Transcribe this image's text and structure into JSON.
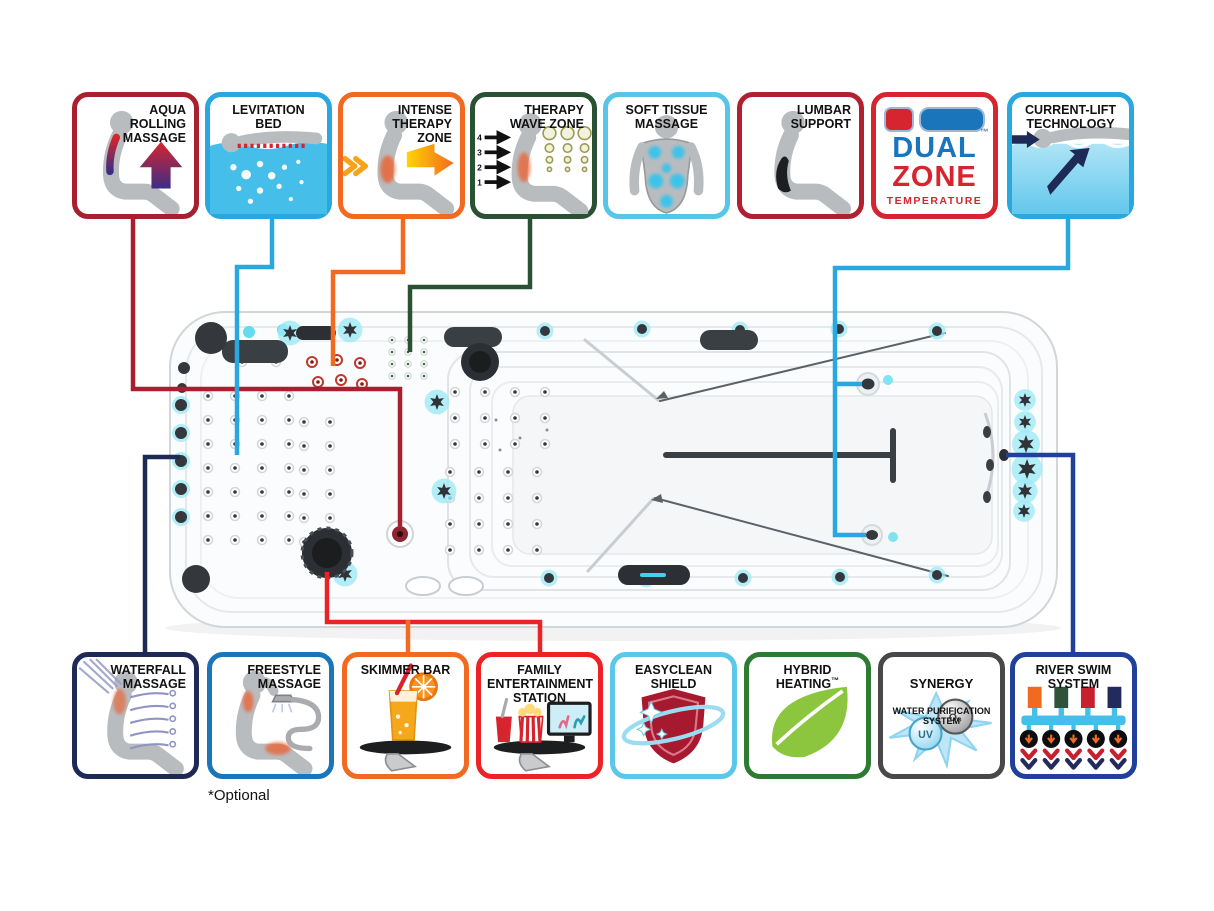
{
  "badges": {
    "aqua_rolling": {
      "label": "AQUA\nROLLING\nMASSAGE",
      "border": "#A8202F",
      "line": "#A8202F"
    },
    "levitation": {
      "label": "LEVITATION\nBED",
      "border": "#29A8DF",
      "line": "#29A8DF"
    },
    "intense": {
      "label": "INTENSE\nTHERAPY\nZONE",
      "border": "#F26A21",
      "line": "#F26A21"
    },
    "therapy_wave": {
      "label": "THERAPY\nWAVE ZONE",
      "border": "#2B5134",
      "line": "#2B5134",
      "jet_numbers": [
        "4",
        "3",
        "2",
        "1"
      ]
    },
    "soft_tissue": {
      "label": "SOFT TISSUE\nMASSAGE",
      "border": "#56C5E8"
    },
    "lumbar": {
      "label": "LUMBAR\nSUPPORT",
      "border": "#B12030"
    },
    "dual_zone": {
      "word1": "DUAL",
      "word2": "ZONE",
      "word3": "TEMPERATURE",
      "tm": "™",
      "border": "#D6252E"
    },
    "current_lift": {
      "label": "CURRENT-LIFT\nTECHNOLOGY",
      "border": "#29A8DF",
      "line": "#29A8DF"
    },
    "waterfall": {
      "label": "WATERFALL\nMASSAGE",
      "border": "#1D2A55",
      "line": "#1D2A55"
    },
    "freestyle": {
      "label": "FREESTYLE\nMASSAGE",
      "border": "#1B75BB"
    },
    "skimmer": {
      "label": "SKIMMER BAR",
      "border": "#F26A21",
      "line": "#F26A21"
    },
    "family": {
      "label": "FAMILY\nENTERTAINMENT\nSTATION",
      "border": "#EC2227",
      "line": "#EC2227"
    },
    "easyclean": {
      "label": "EASYCLEAN\nSHIELD",
      "border": "#5BC8EA"
    },
    "hybrid": {
      "label": "HYBRID\nHEATING",
      "tm": "™",
      "border": "#2D7A33"
    },
    "synergy": {
      "label_main": "SYNERGY",
      "label_sub": "WATER PURIFICATION\nSYSTEM",
      "border": "#48484A",
      "bubble_uv": "UV",
      "bubble_o3": "O₃"
    },
    "river_swim": {
      "label": "RIVER SWIM\nSYSTEM",
      "border": "#21409A",
      "line": "#21409A"
    }
  },
  "note_optional": "*Optional",
  "colors": {
    "jet_glow": "#9FEAF6",
    "tub_dark": "#34383c",
    "water_cyan": "#45BEE9",
    "leaf_green": "#8CC63E",
    "shield_red": "#A6192E"
  }
}
